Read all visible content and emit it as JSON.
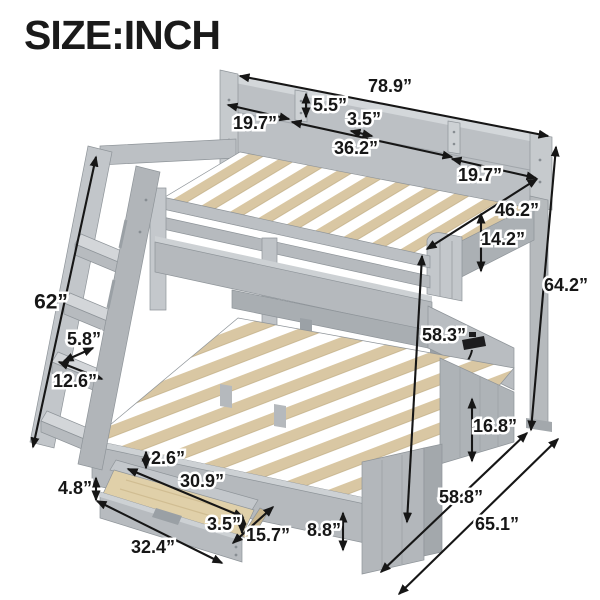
{
  "title": "SIZE:INCH",
  "product": "bunk bed with staircase, shelf headboard and storage drawer",
  "unit": "inch",
  "colors": {
    "frame_gray": "#bcc0c4",
    "frame_light": "#d3d7da",
    "frame_mid": "#adb2b6",
    "frame_dark": "#a3a8ac",
    "slat_wood": "#d9c7a3",
    "drawer_wood": "#e0d0a9",
    "annotation": "#161616",
    "background": "#ffffff"
  },
  "dims": {
    "overall_length": "78.9”",
    "shelf_compartment_left": "19.7”",
    "shelf_height": "5.5”",
    "shelf_board_thickness": "3.5”",
    "shelf_compartment_middle": "36.2”",
    "shelf_compartment_right": "19.7”",
    "top_bunk_width": "46.2”",
    "top_guardrail_height": "14.2”",
    "overall_height": "64.2”",
    "floor_to_guardrail_top": "58.3”",
    "under_bed_clearance": "16.8”",
    "staircase_length": "62”",
    "step_thickness": "5.8”",
    "step_depth": "12.6”",
    "drawer_side_height": "4.8”",
    "drawer_inner_depth": "2.6”",
    "drawer_inner_length": "30.9”",
    "drawer_front_lip_height": "3.5”",
    "drawer_length": "32.4”",
    "drawer_width": "15.7”",
    "footboard_height": "8.8”",
    "full_bed_width": "58.8”",
    "overall_depth": "65.1”"
  }
}
